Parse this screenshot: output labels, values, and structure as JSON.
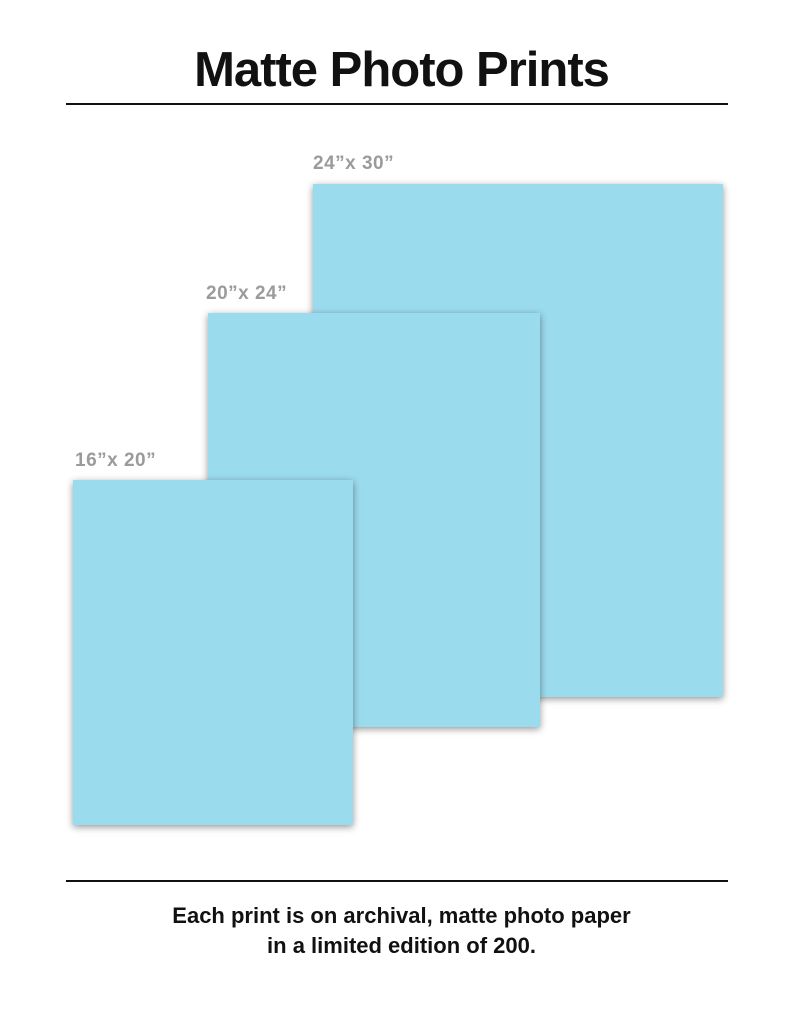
{
  "header": {
    "title": "Matte Photo Prints"
  },
  "prints": [
    {
      "label": "24”x 30”",
      "width_in": 24,
      "height_in": 30
    },
    {
      "label": "20”x 24”",
      "width_in": 20,
      "height_in": 24
    },
    {
      "label": "16”x 20”",
      "width_in": 16,
      "height_in": 20
    }
  ],
  "footer": {
    "line1": "Each print is on archival, matte photo paper",
    "line2": "in a limited edition of 200."
  },
  "colors": {
    "print_fill": "#9BDBEE",
    "label_gray": "#9B9B9B",
    "text_black": "#111111",
    "background": "#FFFFFF"
  }
}
